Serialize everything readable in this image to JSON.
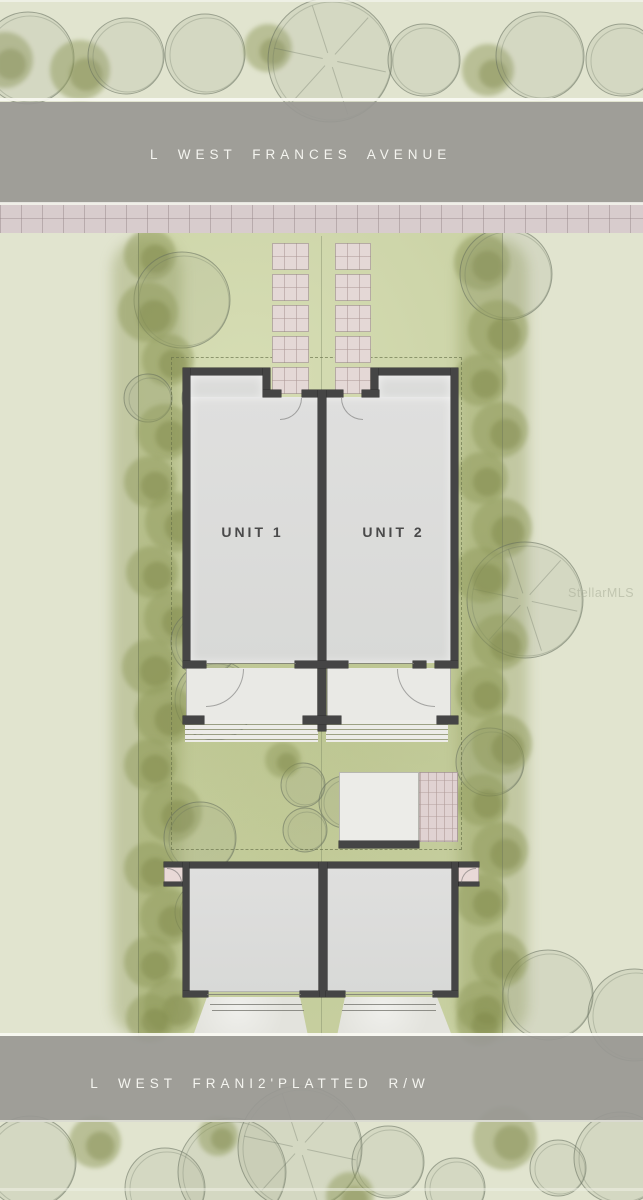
{
  "site_plan": {
    "street_top_label": "L WEST FRANCES AVENUE",
    "street_bottom_label": "L WEST FRANI2'PLATTED R/W",
    "unit1_label": "UNIT 1",
    "unit2_label": "UNIT 2",
    "watermark": "StellarMLS",
    "colors": {
      "road": "#99989 4",
      "sidewalk": "#d8cccd",
      "lawn": "#cad2a5",
      "hedge": "#949e5e",
      "wall": "#454545",
      "paver": "#e4d8d6",
      "interior": "#dcdddc"
    }
  },
  "geometry": {
    "walls": [
      [
        183,
        368,
        87,
        7
      ],
      [
        371,
        368,
        87,
        7
      ],
      [
        263,
        368,
        7,
        29
      ],
      [
        371,
        368,
        7,
        29
      ],
      [
        263,
        390,
        18,
        7
      ],
      [
        362,
        390,
        17,
        7
      ],
      [
        302,
        390,
        41,
        7
      ],
      [
        318,
        390,
        8,
        341
      ],
      [
        183,
        368,
        7,
        300
      ],
      [
        451,
        368,
        7,
        300
      ],
      [
        183,
        661,
        23,
        7
      ],
      [
        295,
        661,
        53,
        7
      ],
      [
        413,
        661,
        13,
        7
      ],
      [
        435,
        661,
        23,
        7
      ],
      [
        183,
        716,
        21,
        8
      ],
      [
        437,
        716,
        21,
        8
      ],
      [
        303,
        716,
        38,
        8
      ],
      [
        183,
        862,
        275,
        6
      ],
      [
        164,
        862,
        20,
        5
      ],
      [
        459,
        862,
        20,
        5
      ],
      [
        164,
        882,
        20,
        4
      ],
      [
        459,
        882,
        20,
        4
      ],
      [
        183,
        862,
        6,
        135
      ],
      [
        452,
        862,
        6,
        135
      ],
      [
        319,
        862,
        8,
        135
      ],
      [
        183,
        991,
        25,
        6
      ],
      [
        300,
        991,
        19,
        6
      ],
      [
        326,
        991,
        19,
        6
      ],
      [
        433,
        991,
        25,
        6
      ],
      [
        339,
        841,
        80,
        7
      ]
    ],
    "thin_lines": [
      [
        206,
        663,
        90,
        1
      ],
      [
        348,
        663,
        66,
        1
      ],
      [
        207,
        994,
        94,
        1
      ],
      [
        345,
        994,
        89,
        1
      ],
      [
        210,
        1004,
        92,
        1
      ],
      [
        212,
        1010,
        92,
        1
      ],
      [
        344,
        1004,
        92,
        1
      ],
      [
        342,
        1010,
        94,
        1
      ]
    ],
    "paver_pads": [
      [
        272,
        243,
        37,
        27
      ],
      [
        272,
        274,
        37,
        27
      ],
      [
        272,
        305,
        37,
        27
      ],
      [
        272,
        336,
        37,
        27
      ],
      [
        272,
        367,
        37,
        27
      ],
      [
        335,
        243,
        36,
        27
      ],
      [
        335,
        274,
        36,
        27
      ],
      [
        335,
        305,
        36,
        27
      ],
      [
        335,
        336,
        36,
        27
      ],
      [
        335,
        367,
        36,
        27
      ]
    ],
    "door_arcs": [
      {
        "x": 280,
        "y": 398,
        "s": 22,
        "c": "br"
      },
      {
        "x": 341,
        "y": 398,
        "s": 22,
        "c": "bl"
      },
      {
        "x": 206,
        "y": 669,
        "s": 38,
        "c": "br"
      },
      {
        "x": 397,
        "y": 669,
        "s": 38,
        "c": "bl"
      },
      {
        "x": 167,
        "y": 868,
        "s": 15,
        "c": "tr"
      },
      {
        "x": 461,
        "y": 868,
        "s": 15,
        "c": "tl"
      }
    ]
  },
  "trees": [
    [
      5,
      60,
      28,
      "b"
    ],
    [
      28,
      58,
      46,
      "o"
    ],
    [
      80,
      70,
      30,
      "b"
    ],
    [
      126,
      56,
      38,
      "o"
    ],
    [
      205,
      54,
      40,
      "o"
    ],
    [
      268,
      48,
      24,
      "b"
    ],
    [
      330,
      60,
      62,
      "s"
    ],
    [
      424,
      60,
      36,
      "o"
    ],
    [
      488,
      70,
      26,
      "b"
    ],
    [
      540,
      56,
      44,
      "o"
    ],
    [
      622,
      60,
      36,
      "o"
    ],
    [
      150,
      255,
      26,
      "b"
    ],
    [
      182,
      300,
      48,
      "o"
    ],
    [
      148,
      312,
      30,
      "b"
    ],
    [
      168,
      360,
      26,
      "b"
    ],
    [
      148,
      398,
      24,
      "o"
    ],
    [
      208,
      398,
      26,
      "o"
    ],
    [
      165,
      432,
      28,
      "b"
    ],
    [
      150,
      482,
      26,
      "b"
    ],
    [
      175,
      522,
      30,
      "b"
    ],
    [
      152,
      572,
      26,
      "b"
    ],
    [
      172,
      618,
      28,
      "b"
    ],
    [
      205,
      642,
      34,
      "o"
    ],
    [
      150,
      667,
      28,
      "b"
    ],
    [
      215,
      700,
      40,
      "o"
    ],
    [
      165,
      715,
      30,
      "b"
    ],
    [
      150,
      765,
      26,
      "b"
    ],
    [
      172,
      812,
      30,
      "b"
    ],
    [
      200,
      838,
      36,
      "o"
    ],
    [
      150,
      868,
      26,
      "b"
    ],
    [
      205,
      912,
      30,
      "o"
    ],
    [
      168,
      917,
      28,
      "b"
    ],
    [
      150,
      962,
      26,
      "b"
    ],
    [
      172,
      1006,
      28,
      "b"
    ],
    [
      150,
      1018,
      24,
      "b"
    ],
    [
      482,
      262,
      28,
      "b"
    ],
    [
      506,
      274,
      46,
      "o"
    ],
    [
      498,
      330,
      30,
      "b"
    ],
    [
      480,
      380,
      26,
      "b"
    ],
    [
      500,
      430,
      28,
      "b"
    ],
    [
      482,
      478,
      26,
      "b"
    ],
    [
      502,
      528,
      30,
      "b"
    ],
    [
      525,
      600,
      58,
      "s"
    ],
    [
      482,
      575,
      28,
      "b"
    ],
    [
      500,
      642,
      28,
      "b"
    ],
    [
      482,
      692,
      26,
      "b"
    ],
    [
      490,
      762,
      34,
      "o"
    ],
    [
      502,
      744,
      30,
      "b"
    ],
    [
      482,
      800,
      26,
      "b"
    ],
    [
      500,
      850,
      28,
      "b"
    ],
    [
      482,
      900,
      26,
      "b"
    ],
    [
      548,
      995,
      45,
      "o"
    ],
    [
      500,
      960,
      28,
      "b"
    ],
    [
      482,
      1006,
      26,
      "b"
    ],
    [
      634,
      1015,
      46,
      "o"
    ],
    [
      480,
      1022,
      24,
      "b"
    ],
    [
      303,
      785,
      22,
      "o"
    ],
    [
      305,
      830,
      22,
      "o"
    ],
    [
      345,
      802,
      26,
      "o"
    ],
    [
      283,
      760,
      18,
      "b"
    ],
    [
      30,
      1162,
      46,
      "o"
    ],
    [
      95,
      1142,
      26,
      "b"
    ],
    [
      165,
      1188,
      40,
      "o"
    ],
    [
      232,
      1172,
      54,
      "o"
    ],
    [
      300,
      1148,
      62,
      "s"
    ],
    [
      388,
      1162,
      36,
      "o"
    ],
    [
      455,
      1188,
      30,
      "o"
    ],
    [
      505,
      1138,
      32,
      "b"
    ],
    [
      558,
      1168,
      28,
      "o"
    ],
    [
      620,
      1158,
      46,
      "o"
    ],
    [
      350,
      1196,
      24,
      "b"
    ],
    [
      218,
      1136,
      20,
      "b"
    ]
  ]
}
